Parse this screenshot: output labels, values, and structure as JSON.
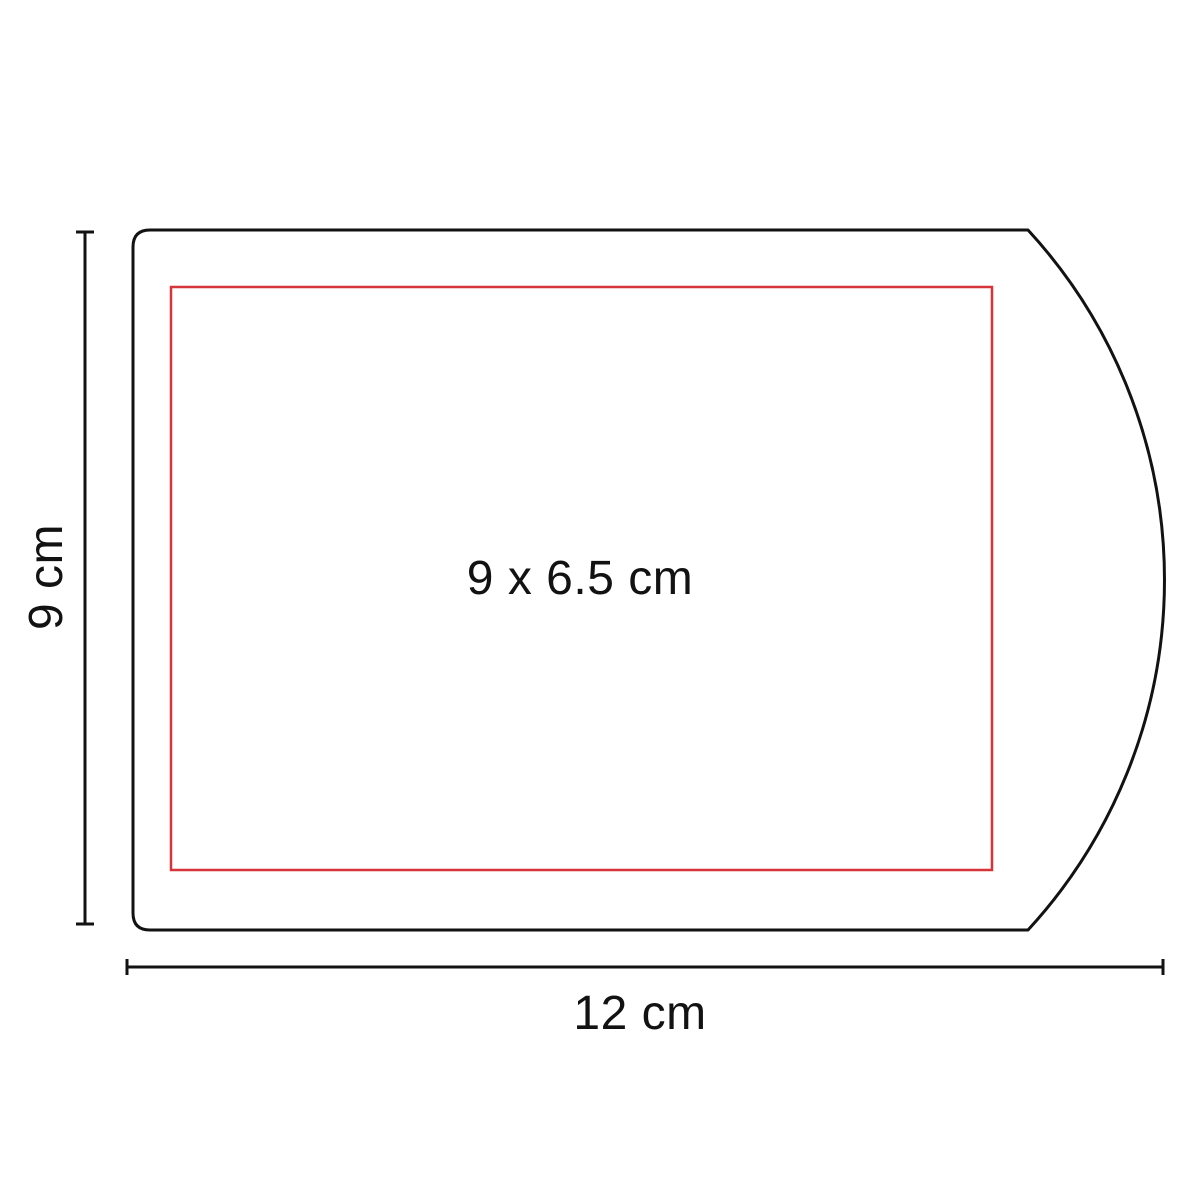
{
  "diagram": {
    "type": "product-dimension-spec",
    "background_color": "#ffffff",
    "outline_color": "#121212",
    "print_area_color": "#d63438",
    "labels": {
      "height": "9 cm",
      "width": "12 cm",
      "print_area": "9 x 6.5 cm"
    }
  }
}
